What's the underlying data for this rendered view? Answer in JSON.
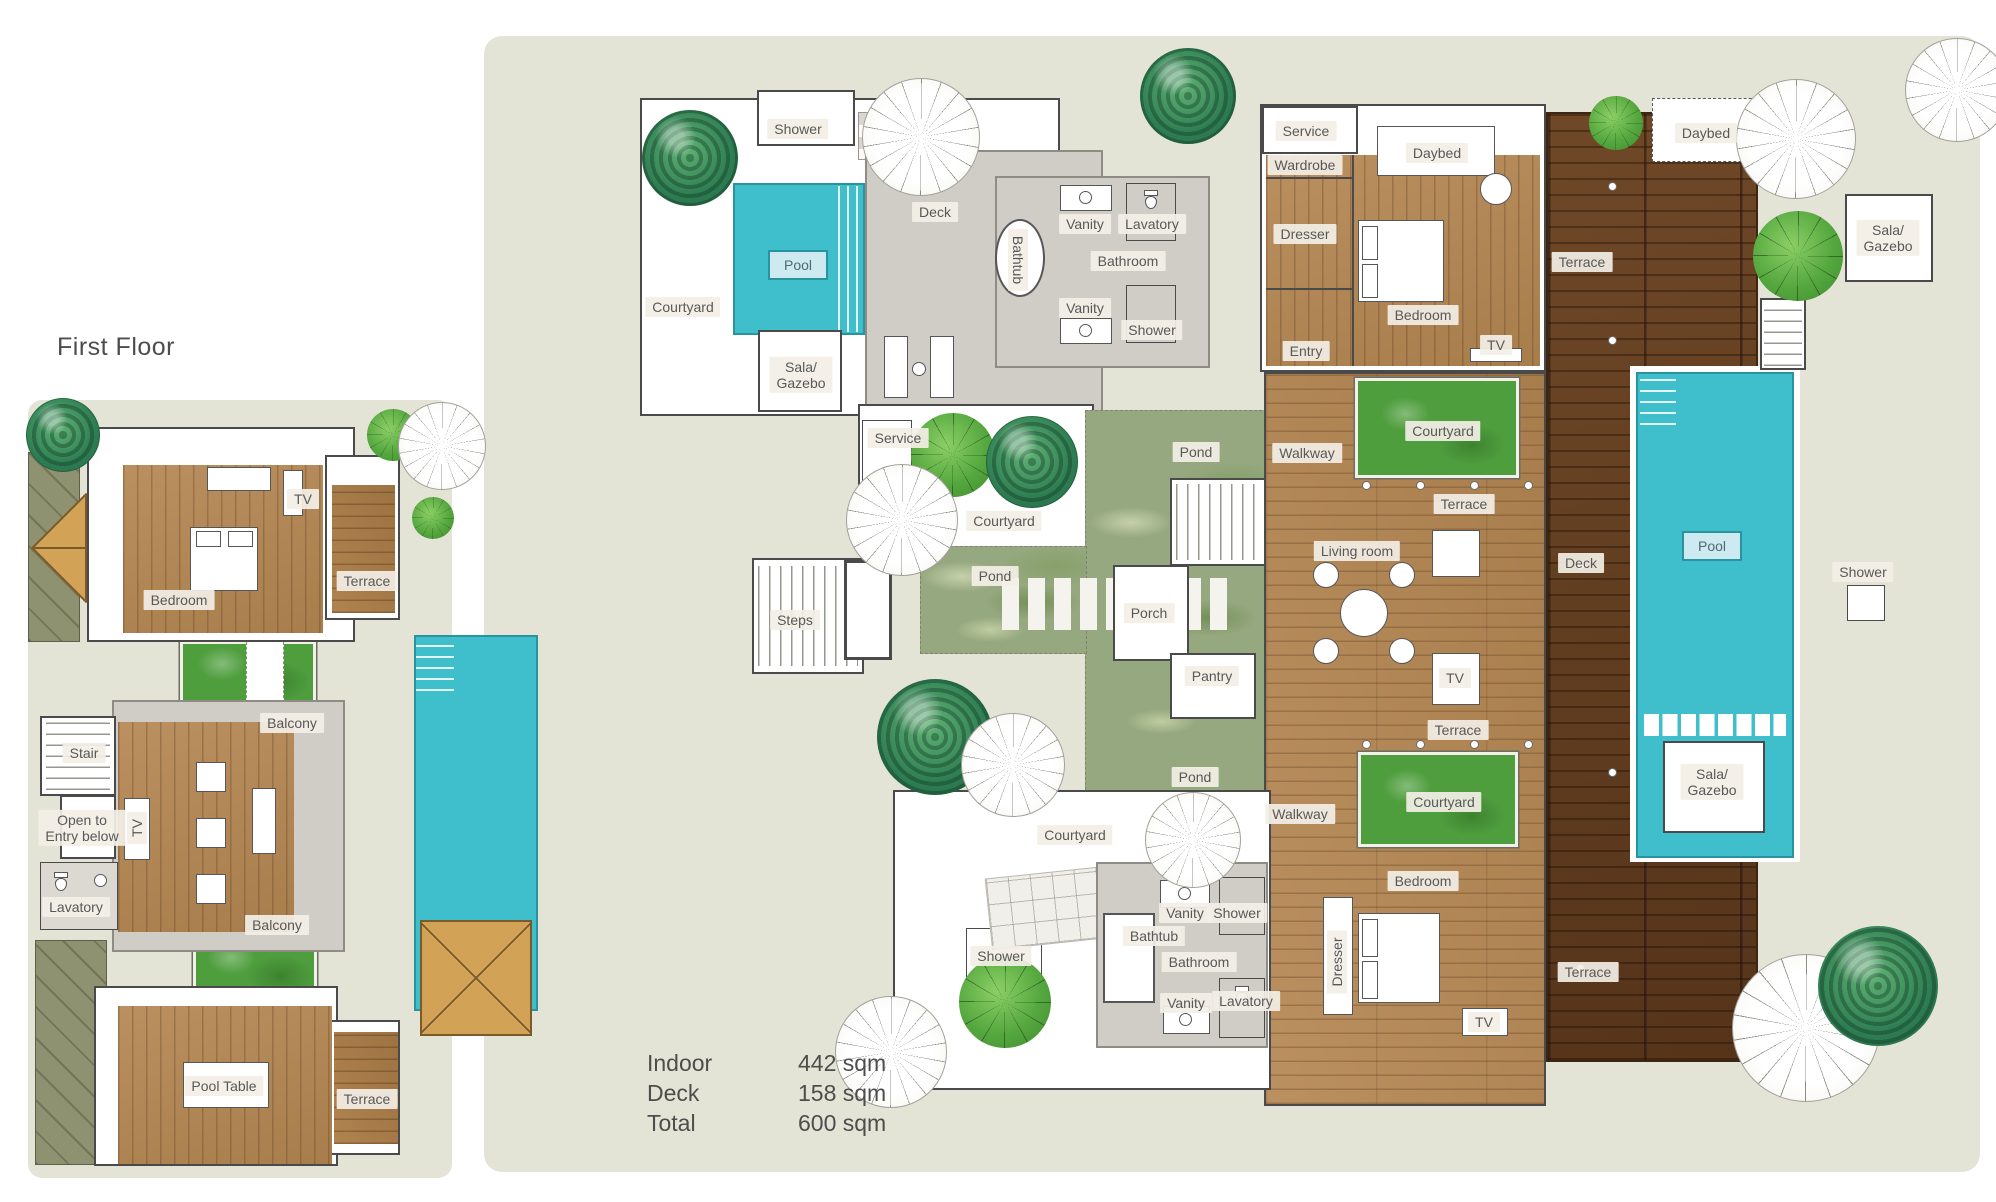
{
  "title": "First Floor",
  "area_summary": {
    "rows": [
      {
        "label": "Indoor",
        "value": "442 sqm"
      },
      {
        "label": "Deck",
        "value": "158 sqm"
      },
      {
        "label": "Total",
        "value": "600 sqm"
      }
    ]
  },
  "colors": {
    "wash": "#e4e4d6",
    "pool": "#3fbfcc",
    "pool_chip": "#cdeaf1",
    "wood_a": "#bb9060",
    "wood_b": "#a87d4c",
    "deck_a": "#6f4827",
    "deck_b": "#55341a",
    "green": "#4f9e3e",
    "pond": "#96a87f",
    "gray": "#d0cdc7",
    "wall": "#4a4a4a",
    "olive": "#8f9270",
    "tan_roof": "#d2a257",
    "label_bg": "rgba(243,239,230,0.92)",
    "label_text": "#585858",
    "ink": "#4d4d4d"
  },
  "left_plan": {
    "name": "first-floor-plan",
    "labels": [
      {
        "id": "left-bedroom",
        "text": "Bedroom",
        "x": 179,
        "y": 600
      },
      {
        "id": "left-tv-bedroom",
        "text": "TV",
        "x": 303,
        "y": 499
      },
      {
        "id": "left-terrace-upper",
        "text": "Terrace",
        "x": 367,
        "y": 581
      },
      {
        "id": "left-balcony-top",
        "text": "Balcony",
        "x": 292,
        "y": 723
      },
      {
        "id": "left-stair",
        "text": "Stair",
        "x": 84,
        "y": 753
      },
      {
        "id": "left-open-entry",
        "text": "Open to\nEntry below",
        "x": 82,
        "y": 828
      },
      {
        "id": "left-tv-lounge",
        "text": "TV",
        "x": 137,
        "y": 828,
        "rot": -90
      },
      {
        "id": "left-lavatory",
        "text": "Lavatory",
        "x": 76,
        "y": 907
      },
      {
        "id": "left-balcony-bottom",
        "text": "Balcony",
        "x": 277,
        "y": 925
      },
      {
        "id": "left-pool-table",
        "text": "Pool Table",
        "x": 224,
        "y": 1086
      },
      {
        "id": "left-terrace-lower",
        "text": "Terrace",
        "x": 367,
        "y": 1099
      }
    ]
  },
  "right_plan": {
    "name": "ground-floor-plan",
    "labels": [
      {
        "id": "shower-top-left",
        "text": "Shower",
        "x": 798,
        "y": 129
      },
      {
        "id": "deck-top-left",
        "text": "Deck",
        "x": 935,
        "y": 212
      },
      {
        "id": "pool-top-left",
        "text": "Pool",
        "x": 798,
        "y": 265,
        "chip": "pool"
      },
      {
        "id": "courtyard-top-left",
        "text": "Courtyard",
        "x": 683,
        "y": 307
      },
      {
        "id": "sala-top-left",
        "text": "Sala/\nGazebo",
        "x": 801,
        "y": 375
      },
      {
        "id": "bathtub-top",
        "text": "Bathtub",
        "x": 1018,
        "y": 260,
        "rot": 90
      },
      {
        "id": "vanity-top-1",
        "text": "Vanity",
        "x": 1085,
        "y": 224
      },
      {
        "id": "lavatory-top",
        "text": "Lavatory",
        "x": 1152,
        "y": 224
      },
      {
        "id": "bathroom-top",
        "text": "Bathroom",
        "x": 1128,
        "y": 261
      },
      {
        "id": "vanity-top-2",
        "text": "Vanity",
        "x": 1085,
        "y": 308
      },
      {
        "id": "shower-top-2",
        "text": "Shower",
        "x": 1152,
        "y": 330
      },
      {
        "id": "service-top",
        "text": "Service",
        "x": 1306,
        "y": 131
      },
      {
        "id": "wardrobe",
        "text": "Wardrobe",
        "x": 1305,
        "y": 165
      },
      {
        "id": "daybed-bedroom",
        "text": "Daybed",
        "x": 1437,
        "y": 153
      },
      {
        "id": "dresser-top",
        "text": "Dresser",
        "x": 1305,
        "y": 234
      },
      {
        "id": "bedroom-top",
        "text": "Bedroom",
        "x": 1423,
        "y": 315
      },
      {
        "id": "tv-bedroom-top",
        "text": "TV",
        "x": 1496,
        "y": 345
      },
      {
        "id": "entry",
        "text": "Entry",
        "x": 1306,
        "y": 351
      },
      {
        "id": "terrace-deck-top",
        "text": "Terrace",
        "x": 1582,
        "y": 262
      },
      {
        "id": "daybed-deck",
        "text": "Daybed",
        "x": 1706,
        "y": 133
      },
      {
        "id": "sala-top-right",
        "text": "Sala/\nGazebo",
        "x": 1888,
        "y": 238
      },
      {
        "id": "service-mid",
        "text": "Service",
        "x": 898,
        "y": 438
      },
      {
        "id": "courtyard-mid",
        "text": "Courtyard",
        "x": 1004,
        "y": 521
      },
      {
        "id": "pond-upper",
        "text": "Pond",
        "x": 1196,
        "y": 452
      },
      {
        "id": "pond-mid",
        "text": "Pond",
        "x": 995,
        "y": 576
      },
      {
        "id": "steps",
        "text": "Steps",
        "x": 795,
        "y": 620
      },
      {
        "id": "porch",
        "text": "Porch",
        "x": 1149,
        "y": 613
      },
      {
        "id": "pantry",
        "text": "Pantry",
        "x": 1212,
        "y": 676
      },
      {
        "id": "walkway-upper",
        "text": "Walkway",
        "x": 1307,
        "y": 453
      },
      {
        "id": "courtyard-green-upper",
        "text": "Courtyard",
        "x": 1443,
        "y": 431
      },
      {
        "id": "terrace-mid-upper",
        "text": "Terrace",
        "x": 1464,
        "y": 504
      },
      {
        "id": "living-room",
        "text": "Living room",
        "x": 1357,
        "y": 551
      },
      {
        "id": "deck-main",
        "text": "Deck",
        "x": 1581,
        "y": 563
      },
      {
        "id": "pool-main",
        "text": "Pool",
        "x": 1712,
        "y": 546,
        "chip": "pool"
      },
      {
        "id": "tv-living",
        "text": "TV",
        "x": 1455,
        "y": 678
      },
      {
        "id": "terrace-mid-lower",
        "text": "Terrace",
        "x": 1458,
        "y": 730
      },
      {
        "id": "walkway-lower",
        "text": "Walkway",
        "x": 1300,
        "y": 814
      },
      {
        "id": "courtyard-green-lower",
        "text": "Courtyard",
        "x": 1444,
        "y": 802
      },
      {
        "id": "pond-lower",
        "text": "Pond",
        "x": 1195,
        "y": 777
      },
      {
        "id": "courtyard-bottom",
        "text": "Courtyard",
        "x": 1075,
        "y": 835
      },
      {
        "id": "shower-bottom-left",
        "text": "Shower",
        "x": 1001,
        "y": 956
      },
      {
        "id": "bathtub-bottom",
        "text": "Bathtub",
        "x": 1154,
        "y": 936
      },
      {
        "id": "vanity-bottom-1",
        "text": "Vanity",
        "x": 1185,
        "y": 913
      },
      {
        "id": "shower-bottom-2",
        "text": "Shower",
        "x": 1237,
        "y": 913
      },
      {
        "id": "bathroom-bottom",
        "text": "Bathroom",
        "x": 1199,
        "y": 962
      },
      {
        "id": "vanity-bottom-2",
        "text": "Vanity",
        "x": 1186,
        "y": 1003
      },
      {
        "id": "lavatory-bottom",
        "text": "Lavatory",
        "x": 1246,
        "y": 1001
      },
      {
        "id": "bedroom-bottom",
        "text": "Bedroom",
        "x": 1423,
        "y": 881
      },
      {
        "id": "dresser-bottom",
        "text": "Dresser",
        "x": 1337,
        "y": 962,
        "rot": -90
      },
      {
        "id": "tv-bedroom-bottom",
        "text": "TV",
        "x": 1484,
        "y": 1022
      },
      {
        "id": "terrace-deck-bottom",
        "text": "Terrace",
        "x": 1588,
        "y": 972
      },
      {
        "id": "sala-pool",
        "text": "Sala/\nGazebo",
        "x": 1712,
        "y": 782
      },
      {
        "id": "shower-right",
        "text": "Shower",
        "x": 1863,
        "y": 572
      }
    ]
  }
}
